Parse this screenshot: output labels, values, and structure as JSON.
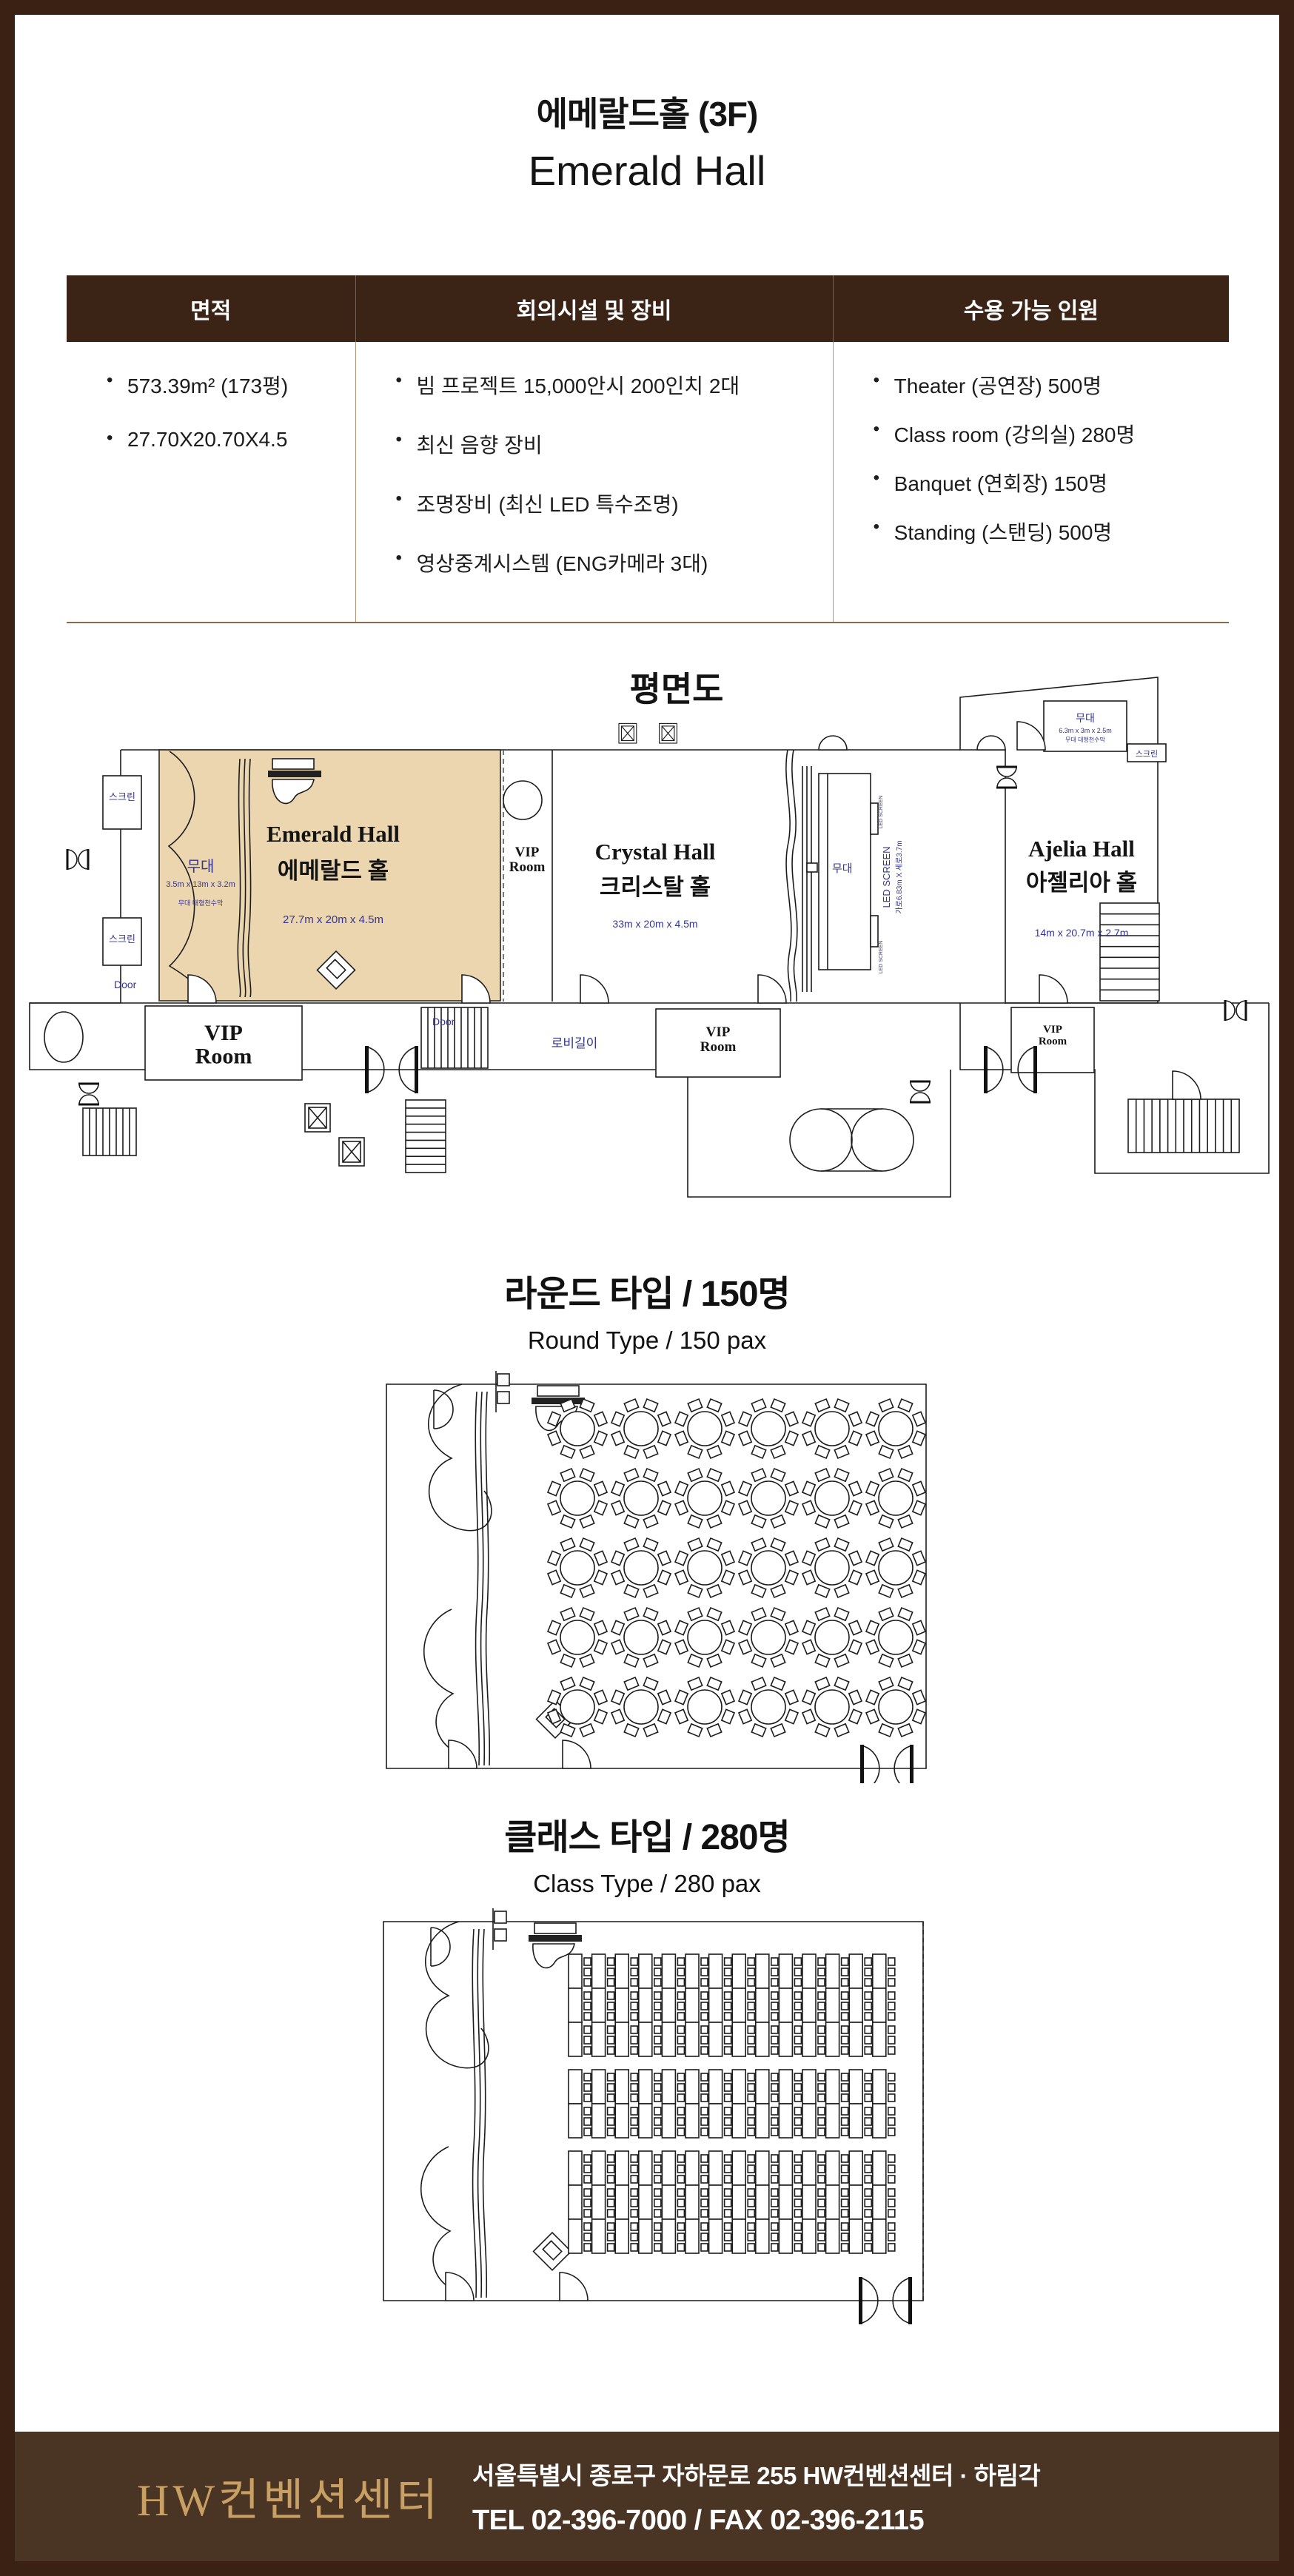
{
  "page": {
    "title_ko": "에메랄드홀 (3F)",
    "title_en": "Emerald Hall"
  },
  "info_table": {
    "headers": [
      "면적",
      "회의시설 및 장비",
      "수용 가능 인원"
    ],
    "area_items": [
      "573.39m² (173평)",
      "27.70X20.70X4.5"
    ],
    "equipment_items": [
      "빔 프로젝트 15,000안시 200인치 2대",
      "최신 음향 장비",
      "조명장비 (최신 LED 특수조명)",
      "영상중계시스템 (ENG카메라 3대)"
    ],
    "capacity_items": [
      "Theater (공연장) 500명",
      "Class room (강의실) 280명",
      "Banquet (연회장) 150명",
      "Standing (스탠딩) 500명"
    ]
  },
  "floor_plan": {
    "title": "평면도",
    "halls": [
      {
        "name_en": "Emerald Hall",
        "name_ko": "에메랄드 홀",
        "dimensions": "27.7m x 20m x 4.5m"
      },
      {
        "name_en": "Crystal Hall",
        "name_ko": "크리스탈 홀",
        "dimensions": "33m x 20m x 4.5m"
      },
      {
        "name_en": "Ajelia Hall",
        "name_ko": "아젤리아 홀",
        "dimensions": "14m x 20.7m x 2.7m"
      }
    ],
    "labels": {
      "vip_room": "VIP Room",
      "stage": "무대",
      "stage_dims": "3.5m x 13m x 3.2m",
      "stage_banner": "무대 대형천수막",
      "ajelia_stage_dims": "6.3m x 3m x 2.5m",
      "screen": "스크린",
      "door": "Door",
      "lobby": "로비길이",
      "led_screen": "LED SCREEN",
      "led_screen_dims": "가로6.83m X 세로3.7m"
    }
  },
  "layouts": {
    "round": {
      "title": "라운드 타입 / 150명",
      "subtitle": "Round Type / 150 pax"
    },
    "class": {
      "title": "클래스 타입 / 280명",
      "subtitle": "Class Type / 280 pax"
    }
  },
  "footer": {
    "brand": "HW컨벤션센터",
    "address": "서울특별시 종로구 자하문로 255 HW컨벤션센터 · 하림각",
    "contact": "TEL 02-396-7000 / FAX 02-396-2115"
  },
  "colors": {
    "frame_brown": "#3A2113",
    "table_header_bg": "#3B2416",
    "footer_bg": "#4A3424",
    "brand_gold": "#C9A063",
    "hall_fill": "#EBD6B0",
    "cad_blue": "#35358F"
  }
}
